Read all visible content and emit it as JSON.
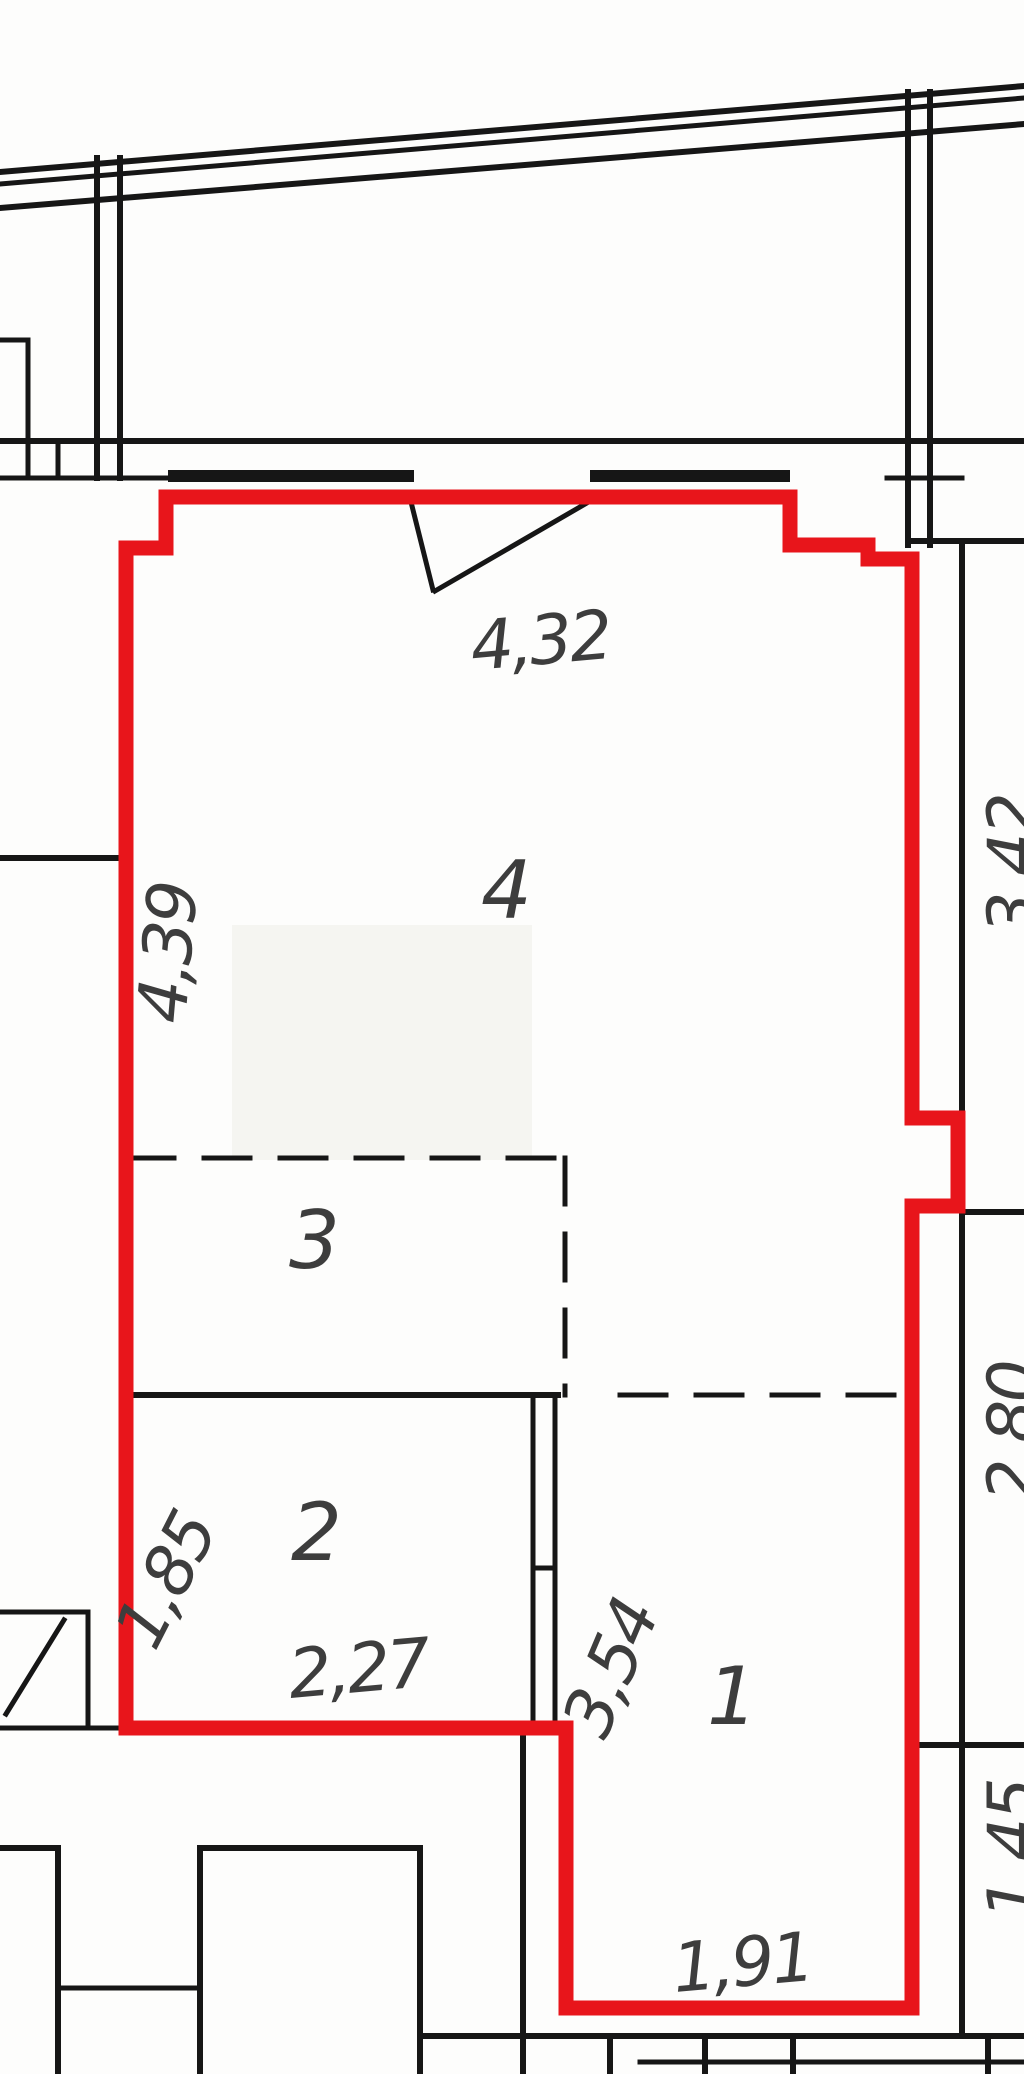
{
  "drawing": {
    "kind": "apartment floor plan with unit boundary highlighted"
  },
  "colors": {
    "outline": "#e8151b",
    "lines": "#161616",
    "text": "#3d3d3d"
  },
  "rooms": {
    "r1": "1",
    "r2": "2",
    "r3": "3",
    "r4": "4"
  },
  "dims": {
    "top": "4,32",
    "left": "4,39",
    "right_top": "3,42",
    "right_mid": "2,80",
    "right_bottom": "1,45",
    "room2_left": "1,85",
    "room2_bottom": "2,27",
    "room1_left": "3,54",
    "bottom": "1,91"
  }
}
